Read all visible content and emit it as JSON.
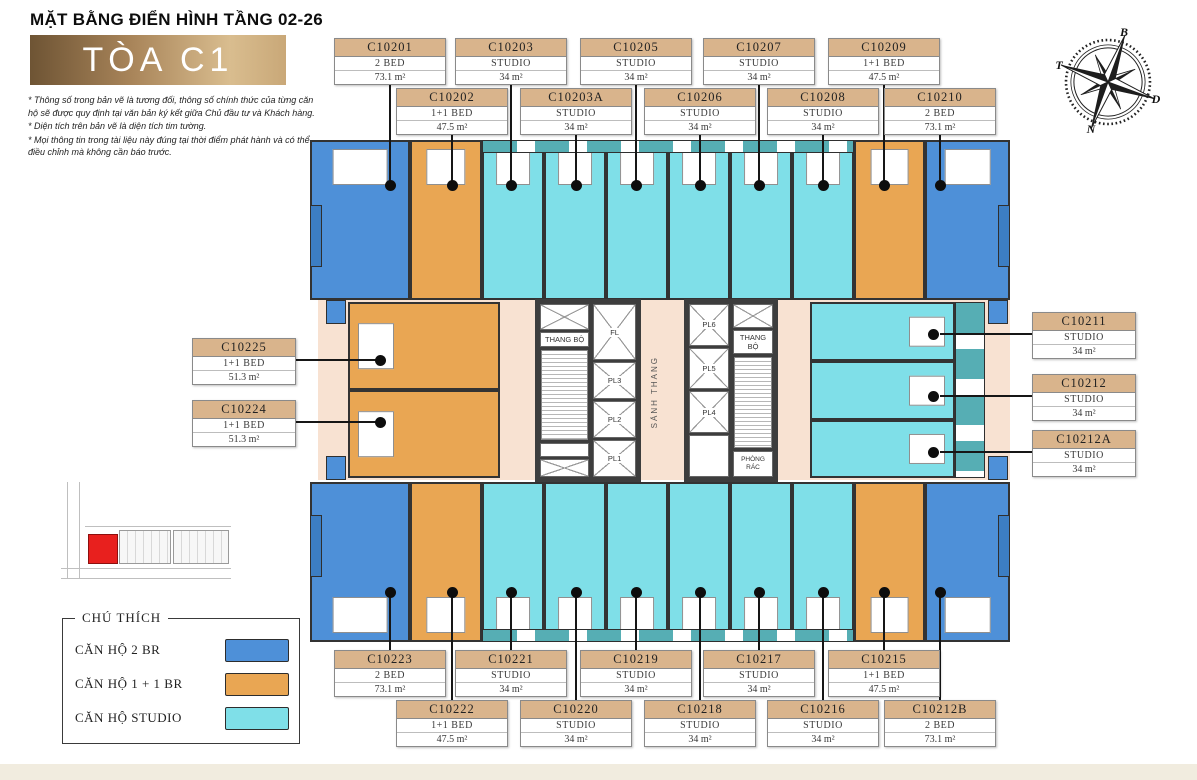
{
  "header": {
    "title": "MẶT BẰNG ĐIỂN HÌNH TẦNG 02-26",
    "building": "TÒA C1",
    "notes": [
      "* Thông số trong bản vẽ là tương đối, thông số chính thức của từng căn hộ sẽ được quy định tại văn bản ký kết giữa Chủ đầu tư và Khách hàng.",
      "* Diện tích trên bản vẽ là diện tích tim tường.",
      "* Mọi thông tin trong tài liệu này đúng tại thời điểm phát hành và có thể điều chỉnh mà không cần báo trước."
    ]
  },
  "compass": {
    "top": "B",
    "right": "D",
    "bottom": "N",
    "left": "T"
  },
  "core": {
    "stair": "THANG BỘ",
    "lobby": "SẢNH THANG",
    "trash": "PHÒNG RÁC",
    "lift_main": "FL",
    "lifts_left": [
      "PL3",
      "PL2",
      "PL1"
    ],
    "lifts_right": [
      "PL6",
      "PL5",
      "PL4"
    ]
  },
  "legend": {
    "title": "CHÚ THÍCH",
    "items": [
      {
        "label": "CĂN HỘ 2 BR",
        "category": "2br"
      },
      {
        "label": "CĂN HỘ 1 + 1 BR",
        "category": "1p1"
      },
      {
        "label": "CĂN HỘ  STUDIO",
        "category": "studio"
      }
    ]
  },
  "colors": {
    "2br": "#4e90d8",
    "1p1": "#e9a653",
    "studio": "#7fdfe8",
    "balcony": "#56aeb4",
    "courtyard": "#f8e2d2",
    "wall": "#333333",
    "label_header": "#d9b48c",
    "highlight_red": "#e8201e"
  },
  "units": [
    {
      "code": "C10201",
      "type": "2 BED",
      "area": "73.1 m²",
      "category": "2br"
    },
    {
      "code": "C10202",
      "type": "1+1 BED",
      "area": "47.5 m²",
      "category": "1p1"
    },
    {
      "code": "C10203",
      "type": "STUDIO",
      "area": "34 m²",
      "category": "studio"
    },
    {
      "code": "C10203A",
      "type": "STUDIO",
      "area": "34 m²",
      "category": "studio"
    },
    {
      "code": "C10205",
      "type": "STUDIO",
      "area": "34 m²",
      "category": "studio"
    },
    {
      "code": "C10206",
      "type": "STUDIO",
      "area": "34 m²",
      "category": "studio"
    },
    {
      "code": "C10207",
      "type": "STUDIO",
      "area": "34 m²",
      "category": "studio"
    },
    {
      "code": "C10208",
      "type": "STUDIO",
      "area": "34 m²",
      "category": "studio"
    },
    {
      "code": "C10209",
      "type": "1+1 BED",
      "area": "47.5 m²",
      "category": "1p1"
    },
    {
      "code": "C10210",
      "type": "2 BED",
      "area": "73.1 m²",
      "category": "2br"
    },
    {
      "code": "C10211",
      "type": "STUDIO",
      "area": "34 m²",
      "category": "studio"
    },
    {
      "code": "C10212",
      "type": "STUDIO",
      "area": "34 m²",
      "category": "studio"
    },
    {
      "code": "C10212A",
      "type": "STUDIO",
      "area": "34 m²",
      "category": "studio"
    },
    {
      "code": "C10212B",
      "type": "2 BED",
      "area": "73.1 m²",
      "category": "2br"
    },
    {
      "code": "C10215",
      "type": "1+1 BED",
      "area": "47.5 m²",
      "category": "1p1"
    },
    {
      "code": "C10216",
      "type": "STUDIO",
      "area": "34 m²",
      "category": "studio"
    },
    {
      "code": "C10217",
      "type": "STUDIO",
      "area": "34 m²",
      "category": "studio"
    },
    {
      "code": "C10218",
      "type": "STUDIO",
      "area": "34 m²",
      "category": "studio"
    },
    {
      "code": "C10219",
      "type": "STUDIO",
      "area": "34 m²",
      "category": "studio"
    },
    {
      "code": "C10220",
      "type": "STUDIO",
      "area": "34 m²",
      "category": "studio"
    },
    {
      "code": "C10221",
      "type": "STUDIO",
      "area": "34 m²",
      "category": "studio"
    },
    {
      "code": "C10222",
      "type": "1+1 BED",
      "area": "47.5 m²",
      "category": "1p1"
    },
    {
      "code": "C10223",
      "type": "2 BED",
      "area": "73.1 m²",
      "category": "2br"
    },
    {
      "code": "C10224",
      "type": "1+1 BED",
      "area": "51.3 m²",
      "category": "1p1"
    },
    {
      "code": "C10225",
      "type": "1+1 BED",
      "area": "51.3 m²",
      "category": "1p1"
    }
  ]
}
